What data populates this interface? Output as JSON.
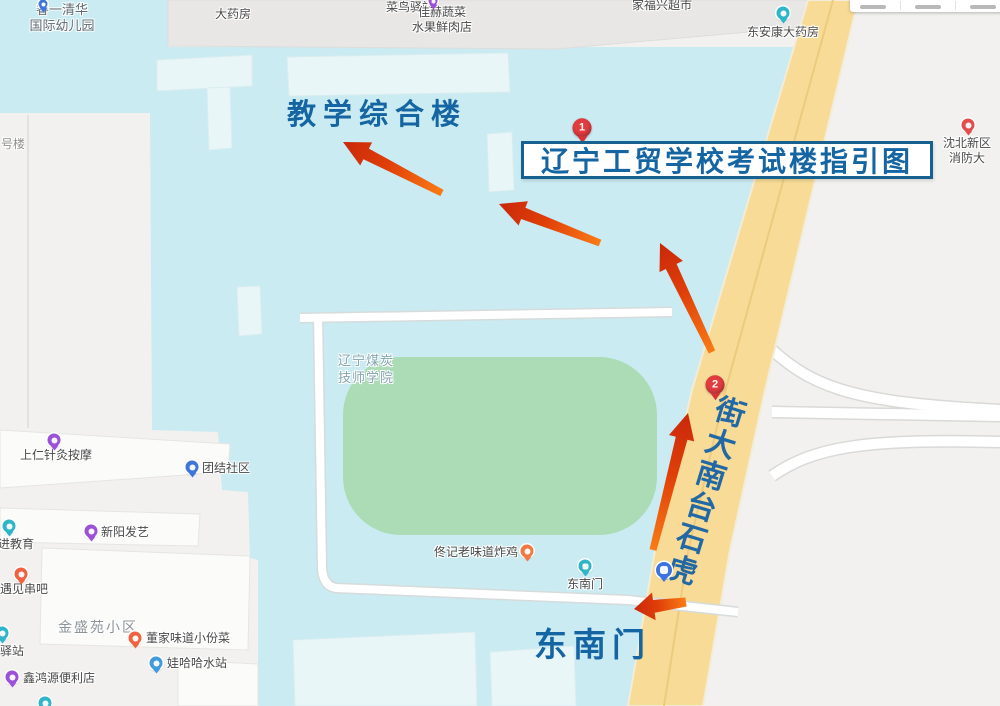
{
  "map": {
    "title_annotation": "辽宁工贸学校考试楼指引图",
    "building_annotation": "教学综合楼",
    "gate_annotation": "东南门",
    "road_name": "虎石台南大街"
  },
  "colors": {
    "campus_fill": "#C9EBF1",
    "field_green": "#ABDCB5",
    "road_yellow": "#F7DB97",
    "annotation_blue": "#1565A3",
    "arrow_orange": "#F97B16",
    "arrow_red": "#C9280B",
    "marker_red": "#E23C40"
  },
  "markers": [
    {
      "num": "1",
      "x": 582,
      "y": 143
    },
    {
      "num": "2",
      "x": 715,
      "y": 400
    }
  ],
  "route_arrows": [
    {
      "x1": 442,
      "y1": 193,
      "x2": 343,
      "y2": 142
    },
    {
      "x1": 600,
      "y1": 243,
      "x2": 499,
      "y2": 204
    },
    {
      "x1": 712,
      "y1": 352,
      "x2": 660,
      "y2": 243
    },
    {
      "x1": 653,
      "y1": 550,
      "x2": 688,
      "y2": 413
    },
    {
      "x1": 686,
      "y1": 602,
      "x2": 634,
      "y2": 609,
      "short": true
    }
  ],
  "pois": [
    {
      "id": "kindergarten",
      "lines": [
        "睿一清华",
        "国际幼儿园"
      ],
      "pin": {
        "color": "#3F74D9",
        "x": 43,
        "y": 4,
        "small": true
      },
      "label": {
        "x": 62,
        "y": 2,
        "align": "center",
        "style": "kg"
      }
    },
    {
      "id": "pharmacy-top",
      "lines": [
        "大药房"
      ],
      "pin": null,
      "label": {
        "x": 233,
        "y": 7,
        "align": "center",
        "style": "poi"
      }
    },
    {
      "id": "cainiao-station",
      "lines": [
        "菜鸟驿站"
      ],
      "pin": null,
      "label": {
        "x": 410,
        "y": 0,
        "align": "center",
        "style": "poi"
      }
    },
    {
      "id": "jiahe-grocery",
      "lines": [
        "佳赫蔬菜",
        "水果鲜肉店"
      ],
      "pin": {
        "color": "#9B51D8",
        "x": 433,
        "y": 1,
        "small": true
      },
      "label": {
        "x": 442,
        "y": 5,
        "align": "center",
        "style": "poi"
      }
    },
    {
      "id": "jiafuxing-market",
      "lines": [
        "家福兴超市"
      ],
      "pin": null,
      "label": {
        "x": 662,
        "y": -2,
        "align": "center",
        "style": "poi"
      }
    },
    {
      "id": "dongankang-pharmacy",
      "lines": [
        "东安康大药房"
      ],
      "pin": {
        "color": "#2FB5C8",
        "x": 783,
        "y": 13
      },
      "label": {
        "x": 783,
        "y": 25,
        "align": "center",
        "style": "poi"
      }
    },
    {
      "id": "fire-brigade",
      "lines": [
        "沈北新区",
        "消防大"
      ],
      "pin": {
        "color": "#E34D4F",
        "x": 968,
        "y": 125
      },
      "label": {
        "x": 967,
        "y": 136,
        "align": "center",
        "style": "poi"
      }
    },
    {
      "id": "haolou",
      "lines": [
        "号楼"
      ],
      "pin": null,
      "label": {
        "x": 1,
        "y": 137,
        "align": "left",
        "style": "poi faint"
      }
    },
    {
      "id": "shangren-massage",
      "lines": [
        "上仁针灸按摩"
      ],
      "pin": {
        "color": "#9B51D8",
        "x": 54,
        "y": 440
      },
      "label": {
        "x": 56,
        "y": 448,
        "align": "center",
        "style": "poi"
      }
    },
    {
      "id": "tuanjie-community",
      "lines": [
        "团结社区"
      ],
      "pin": {
        "color": "#3F74D9",
        "x": 192,
        "y": 467
      },
      "label": {
        "x": 202,
        "y": 461,
        "align": "left",
        "style": "poi"
      }
    },
    {
      "id": "jin-education",
      "lines": [
        "进教育"
      ],
      "pin": {
        "color": "#2FB5C8",
        "x": 9,
        "y": 526
      },
      "label": {
        "x": -2,
        "y": 537,
        "align": "left",
        "style": "poi"
      }
    },
    {
      "id": "xinyang-hair",
      "lines": [
        "新阳发艺"
      ],
      "pin": {
        "color": "#9B51D8",
        "x": 91,
        "y": 531
      },
      "label": {
        "x": 101,
        "y": 525,
        "align": "left",
        "style": "poi"
      }
    },
    {
      "id": "yujian-bbq",
      "lines": [
        "遇见串吧"
      ],
      "pin": {
        "color": "#F0623F",
        "x": 21,
        "y": 574
      },
      "label": {
        "x": 0,
        "y": 582,
        "align": "left",
        "style": "poi"
      }
    },
    {
      "id": "jinshengyuan-estate",
      "lines": [
        "金盛苑小区"
      ],
      "pin": null,
      "label": {
        "x": 58,
        "y": 620,
        "align": "left",
        "style": "area"
      }
    },
    {
      "id": "dongjia-dishes",
      "lines": [
        "董家味道小份菜"
      ],
      "pin": {
        "color": "#F0623F",
        "x": 135,
        "y": 638
      },
      "label": {
        "x": 146,
        "y": 631,
        "align": "left",
        "style": "poi"
      }
    },
    {
      "id": "yizhan",
      "lines": [
        "驿站"
      ],
      "pin": {
        "color": "#2FB5C8",
        "x": 2,
        "y": 633
      },
      "label": {
        "x": 0,
        "y": 644,
        "align": "left",
        "style": "poi"
      }
    },
    {
      "id": "wahaha-water",
      "lines": [
        "娃哈哈水站"
      ],
      "pin": {
        "color": "#3F9BDC",
        "x": 156,
        "y": 663
      },
      "label": {
        "x": 167,
        "y": 656,
        "align": "left",
        "style": "poi"
      }
    },
    {
      "id": "xinhongyuan-store",
      "lines": [
        "鑫鸿源便利店"
      ],
      "pin": {
        "color": "#9B51D8",
        "x": 12,
        "y": 677
      },
      "label": {
        "x": 23,
        "y": 671,
        "align": "left",
        "style": "poi"
      }
    },
    {
      "id": "tongji-chicken",
      "lines": [
        "佟记老味道炸鸡"
      ],
      "pin": {
        "color": "#F07842",
        "x": 527,
        "y": 551
      },
      "label": {
        "x": 518,
        "y": 545,
        "align": "right",
        "style": "poi"
      }
    },
    {
      "id": "campus-name",
      "lines": [
        "辽宁煤炭",
        "技师学院"
      ],
      "pin": null,
      "label": {
        "x": 338,
        "y": 352,
        "align": "left",
        "style": "campus"
      }
    },
    {
      "id": "se-gate-poi",
      "lines": [
        "东南门"
      ],
      "pin": {
        "color": "#2FB5C8",
        "x": 585,
        "y": 566,
        "kind": "gate"
      },
      "label": {
        "x": 585,
        "y": 577,
        "align": "center",
        "style": "poi"
      }
    },
    {
      "id": "bus-stop",
      "lines": [],
      "pin": {
        "color": "#3D73E0",
        "x": 664,
        "y": 570,
        "kind": "bus"
      },
      "label": null
    },
    {
      "id": "edge-pin-bottom",
      "lines": [],
      "pin": {
        "color": "#2FB5C8",
        "x": 45,
        "y": 703
      },
      "label": null
    }
  ]
}
